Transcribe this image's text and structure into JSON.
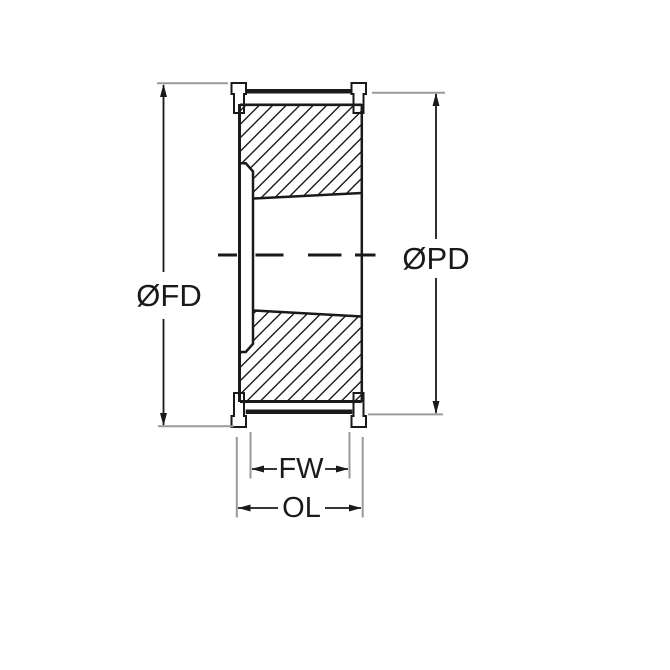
{
  "drawing": {
    "title": "timing-pulley-cross-section",
    "labels": {
      "flange_diameter": "ØFD",
      "pitch_diameter": "ØPD",
      "face_width": "FW",
      "overall_length": "OL"
    },
    "colors": {
      "line": "#1a1a1a",
      "extension_line": "#9a9a9a",
      "background": "#ffffff"
    }
  }
}
